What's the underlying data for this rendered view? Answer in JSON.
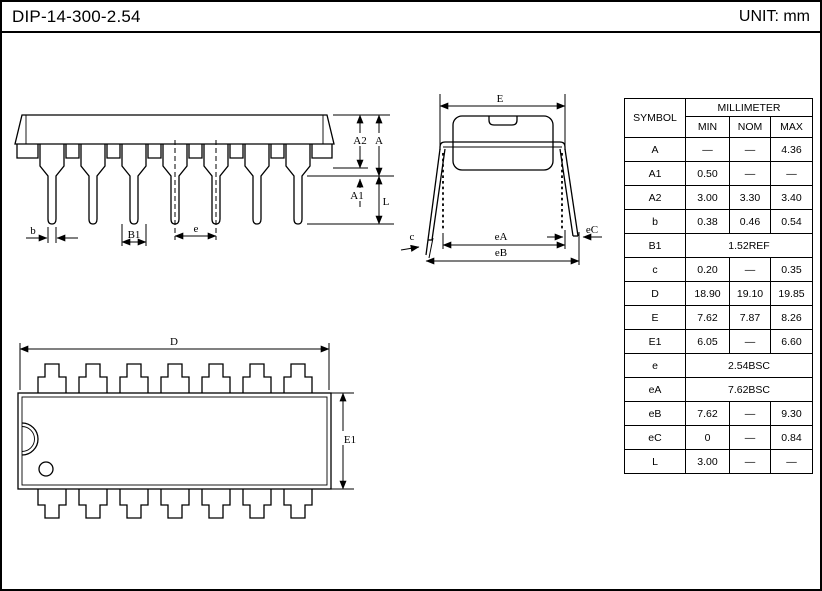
{
  "header": {
    "title": "DIP-14-300-2.54",
    "unit_label": "UNIT: mm"
  },
  "table": {
    "symbol_header": "SYMBOL",
    "group_header": "MILLIMETER",
    "col_headers": [
      "MIN",
      "NOM",
      "MAX"
    ],
    "rows": [
      {
        "sym": "A",
        "min": "—",
        "nom": "—",
        "max": "4.36"
      },
      {
        "sym": "A1",
        "min": "0.50",
        "nom": "—",
        "max": "—"
      },
      {
        "sym": "A2",
        "min": "3.00",
        "nom": "3.30",
        "max": "3.40"
      },
      {
        "sym": "b",
        "min": "0.38",
        "nom": "0.46",
        "max": "0.54"
      },
      {
        "sym": "B1",
        "span": "1.52REF"
      },
      {
        "sym": "c",
        "min": "0.20",
        "nom": "—",
        "max": "0.35"
      },
      {
        "sym": "D",
        "min": "18.90",
        "nom": "19.10",
        "max": "19.85"
      },
      {
        "sym": "E",
        "min": "7.62",
        "nom": "7.87",
        "max": "8.26"
      },
      {
        "sym": "E1",
        "min": "6.05",
        "nom": "—",
        "max": "6.60"
      },
      {
        "sym": "e",
        "span": "2.54BSC"
      },
      {
        "sym": "eA",
        "span": "7.62BSC"
      },
      {
        "sym": "eB",
        "min": "7.62",
        "nom": "—",
        "max": "9.30"
      },
      {
        "sym": "eC",
        "min": "0",
        "nom": "—",
        "max": "0.84"
      },
      {
        "sym": "L",
        "min": "3.00",
        "nom": "—",
        "max": "—"
      }
    ]
  },
  "labels": {
    "side": {
      "b": "b",
      "b1": "B1",
      "e": "e",
      "a2": "A2",
      "a": "A",
      "a1": "A1",
      "l": "L"
    },
    "end": {
      "e": "E",
      "c": "c",
      "ea": "eA",
      "eb": "eB",
      "ec": "eC"
    },
    "top": {
      "d": "D",
      "e1": "E1"
    }
  }
}
